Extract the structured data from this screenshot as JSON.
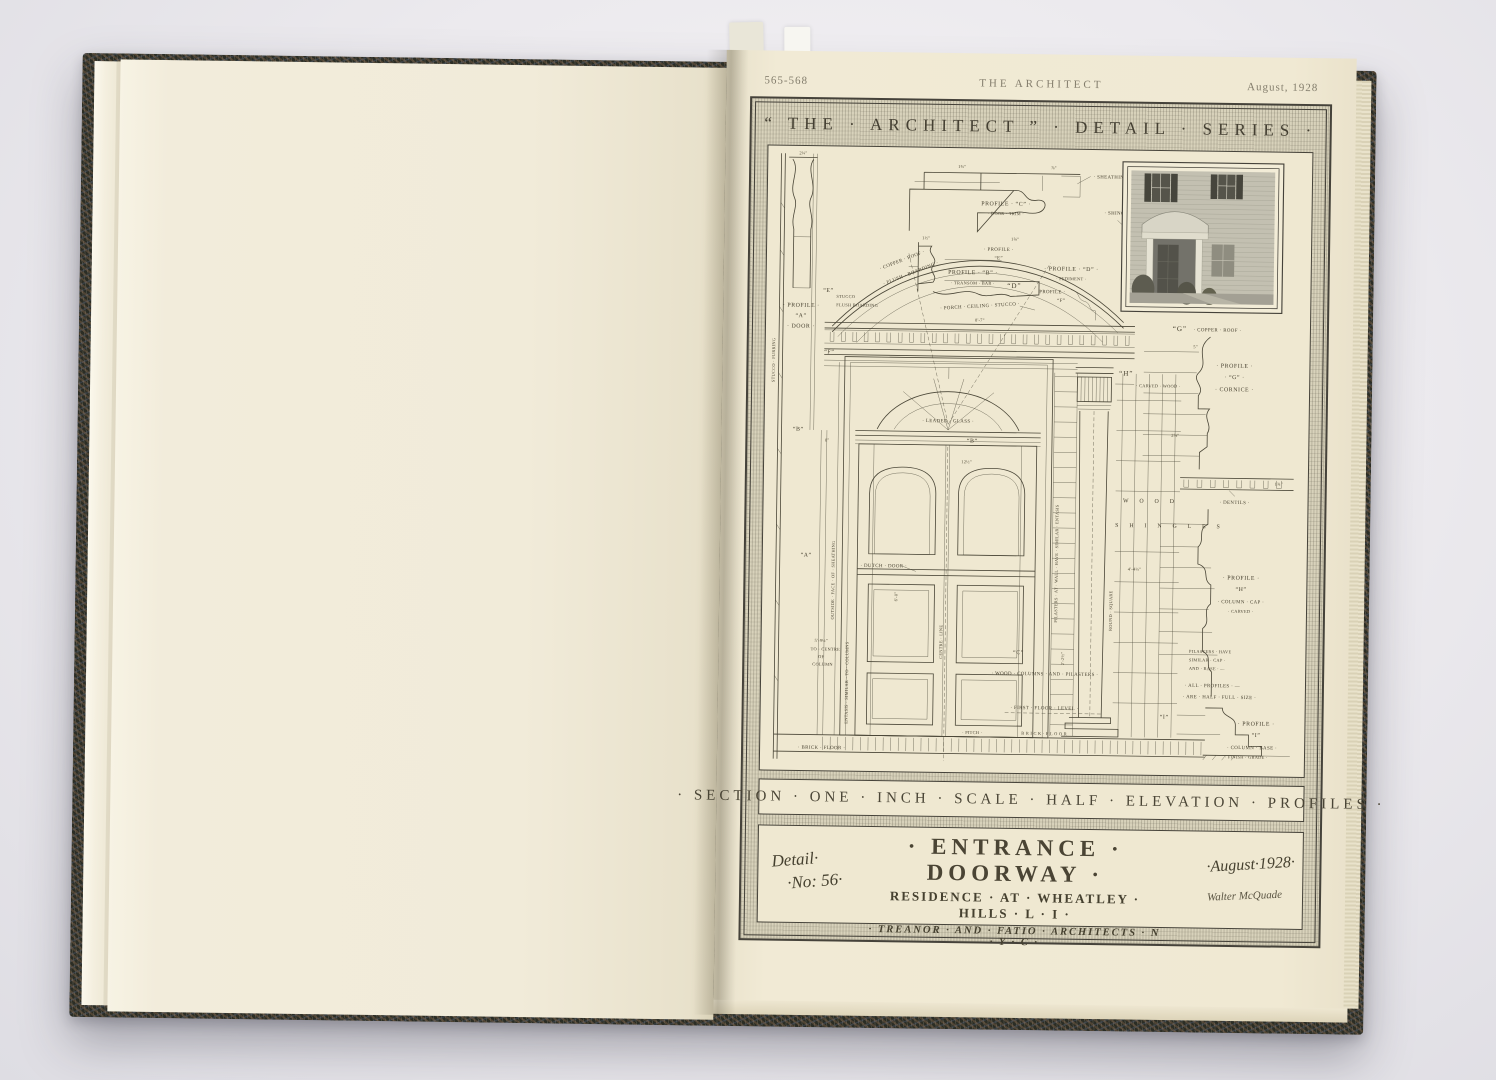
{
  "photo_header": {
    "page_numbers": "565-568",
    "journal": "THE ARCHITECT",
    "issue_date": "August, 1928"
  },
  "plate": {
    "series_title": "“ THE · ARCHITECT ” · DETAIL · SERIES ·",
    "scale_line": "· SECTION · ONE · INCH · SCALE · HALF · ELEVATION · PROFILES ·",
    "title_block": {
      "detail_word": "Detail·",
      "detail_no": "·No: 56·",
      "main_title": "· ENTRANCE · DOORWAY ·",
      "residence_line": "RESIDENCE · AT · WHEATLEY · HILLS · L · I ·",
      "architects_line": "· TREANOR · AND · FATIO · ARCHITECTS · N · Y · C ·",
      "issue_script": "·August·1928·",
      "signature": "Walter McQuade"
    },
    "ann": {
      "profile_a_1": "· PROFILE ·",
      "profile_a_2": "“A”",
      "profile_a_3": "· DOOR ·",
      "profile_b": "PROFILE · “B” ·",
      "transom_bar": "· TRANSOM · BAR ·",
      "profile_c": "PROFILE · “C” ·",
      "door_trim": "· DOOR · TRIM ·",
      "sheathing": "· SHEATHING ·",
      "shingles_top": "· SHINGLES ·",
      "profile_d": "· PROFILE · “D” ·",
      "pediment": "· PEDIMENT ·",
      "profile_e_1": "· PROFILE ·",
      "profile_e_2": "“E”",
      "profile_f_1": "PROFILE ·",
      "profile_f_2": "“F”",
      "copper_roof_curve": "· COPPER · ROOF ·",
      "flush_boarding_curve": "· FLUSH · BOARDING ·",
      "porch_ceiling": "· PORCH · CEILING · STUCCO ·",
      "stucco_small": "STUCCO",
      "flush_boarding_small": "FLUSH BOARDING",
      "copper_roof_g": "· COPPER · ROOF ·",
      "profile_g_1": "· PROFILE ·",
      "profile_g_2": "· “G” ·",
      "cornice": "· CORNICE ·",
      "carved_wood": "· CARVED · WOOD ·",
      "dentils": "· DENTILS ·",
      "profile_h_1": "· PROFILE ·",
      "profile_h_2": "“H”",
      "column_cap": "· COLUMN · CAP ·",
      "carved": "· CARVED ·",
      "pilasters_1": "PILASTERS · HAVE",
      "pilasters_2": "SIMILAR · CAP ·",
      "pilasters_3": "AND · BASE · —",
      "half_1": "· ALL · PROFILES · —",
      "half_2": "· ARE · HALF · FULL · SIZE ·",
      "profile_i_1": "· PROFILE ·",
      "profile_i_2": "“I”",
      "column_base": "· COLUMN · BASE ·",
      "finish_grade": "· FINISH · GRADE ·",
      "leaded_glass": "· LEADED · GLASS ·",
      "dutch_door": "· DUTCH · DOOR ·",
      "wood_sp": "W O O D",
      "shingles_sp": "S H I N G L E S",
      "wood_columns": "· WOOD · COLUMNS · AND · PILASTERS ·",
      "first_floor": "· FIRST · FLOOR · LEVEL ·",
      "pitch": "· PITCH ·",
      "brick_floor_sp": "B R I C K · F L O O R",
      "brick_floor": "· BRICK · FLOOR ·",
      "centre_line": "CENTRE · LINE",
      "entasis_columns": "ENTASIS · SIMILAR · TO · COLUMNS",
      "outside_face": "OUTSIDE · FACE · OF · SHEATHING",
      "stucco_furring": "STUCCO · FURRING",
      "to_centre_1": "TO · CENTRE",
      "to_centre_2": "OF",
      "to_centre_3": "COLUMN",
      "pilasters_wall": "PILASTERS · AT · WALL · HAVE · SIMILAR · ENTASIS",
      "round_square": "ROUND · SQUARE"
    },
    "markers": {
      "a": "“A”",
      "b1": "“B”",
      "b2": "“B”",
      "c": "“C”",
      "d": "“D”",
      "e": "“E”",
      "f": "“F”",
      "g": "“G”",
      "h": "“H”",
      "i": "“I”"
    },
    "dims": [
      "2¼\"",
      "1¾\"",
      "⅞\"",
      "1½\"",
      "1⅝\"",
      "5\"",
      "8\"",
      "12½\"",
      "8'-7\"",
      "6'-0\"",
      "5'-9¼\"",
      "4'-4¼\"",
      "2⅝\"",
      "1¾\"",
      "2'-2½\""
    ]
  }
}
